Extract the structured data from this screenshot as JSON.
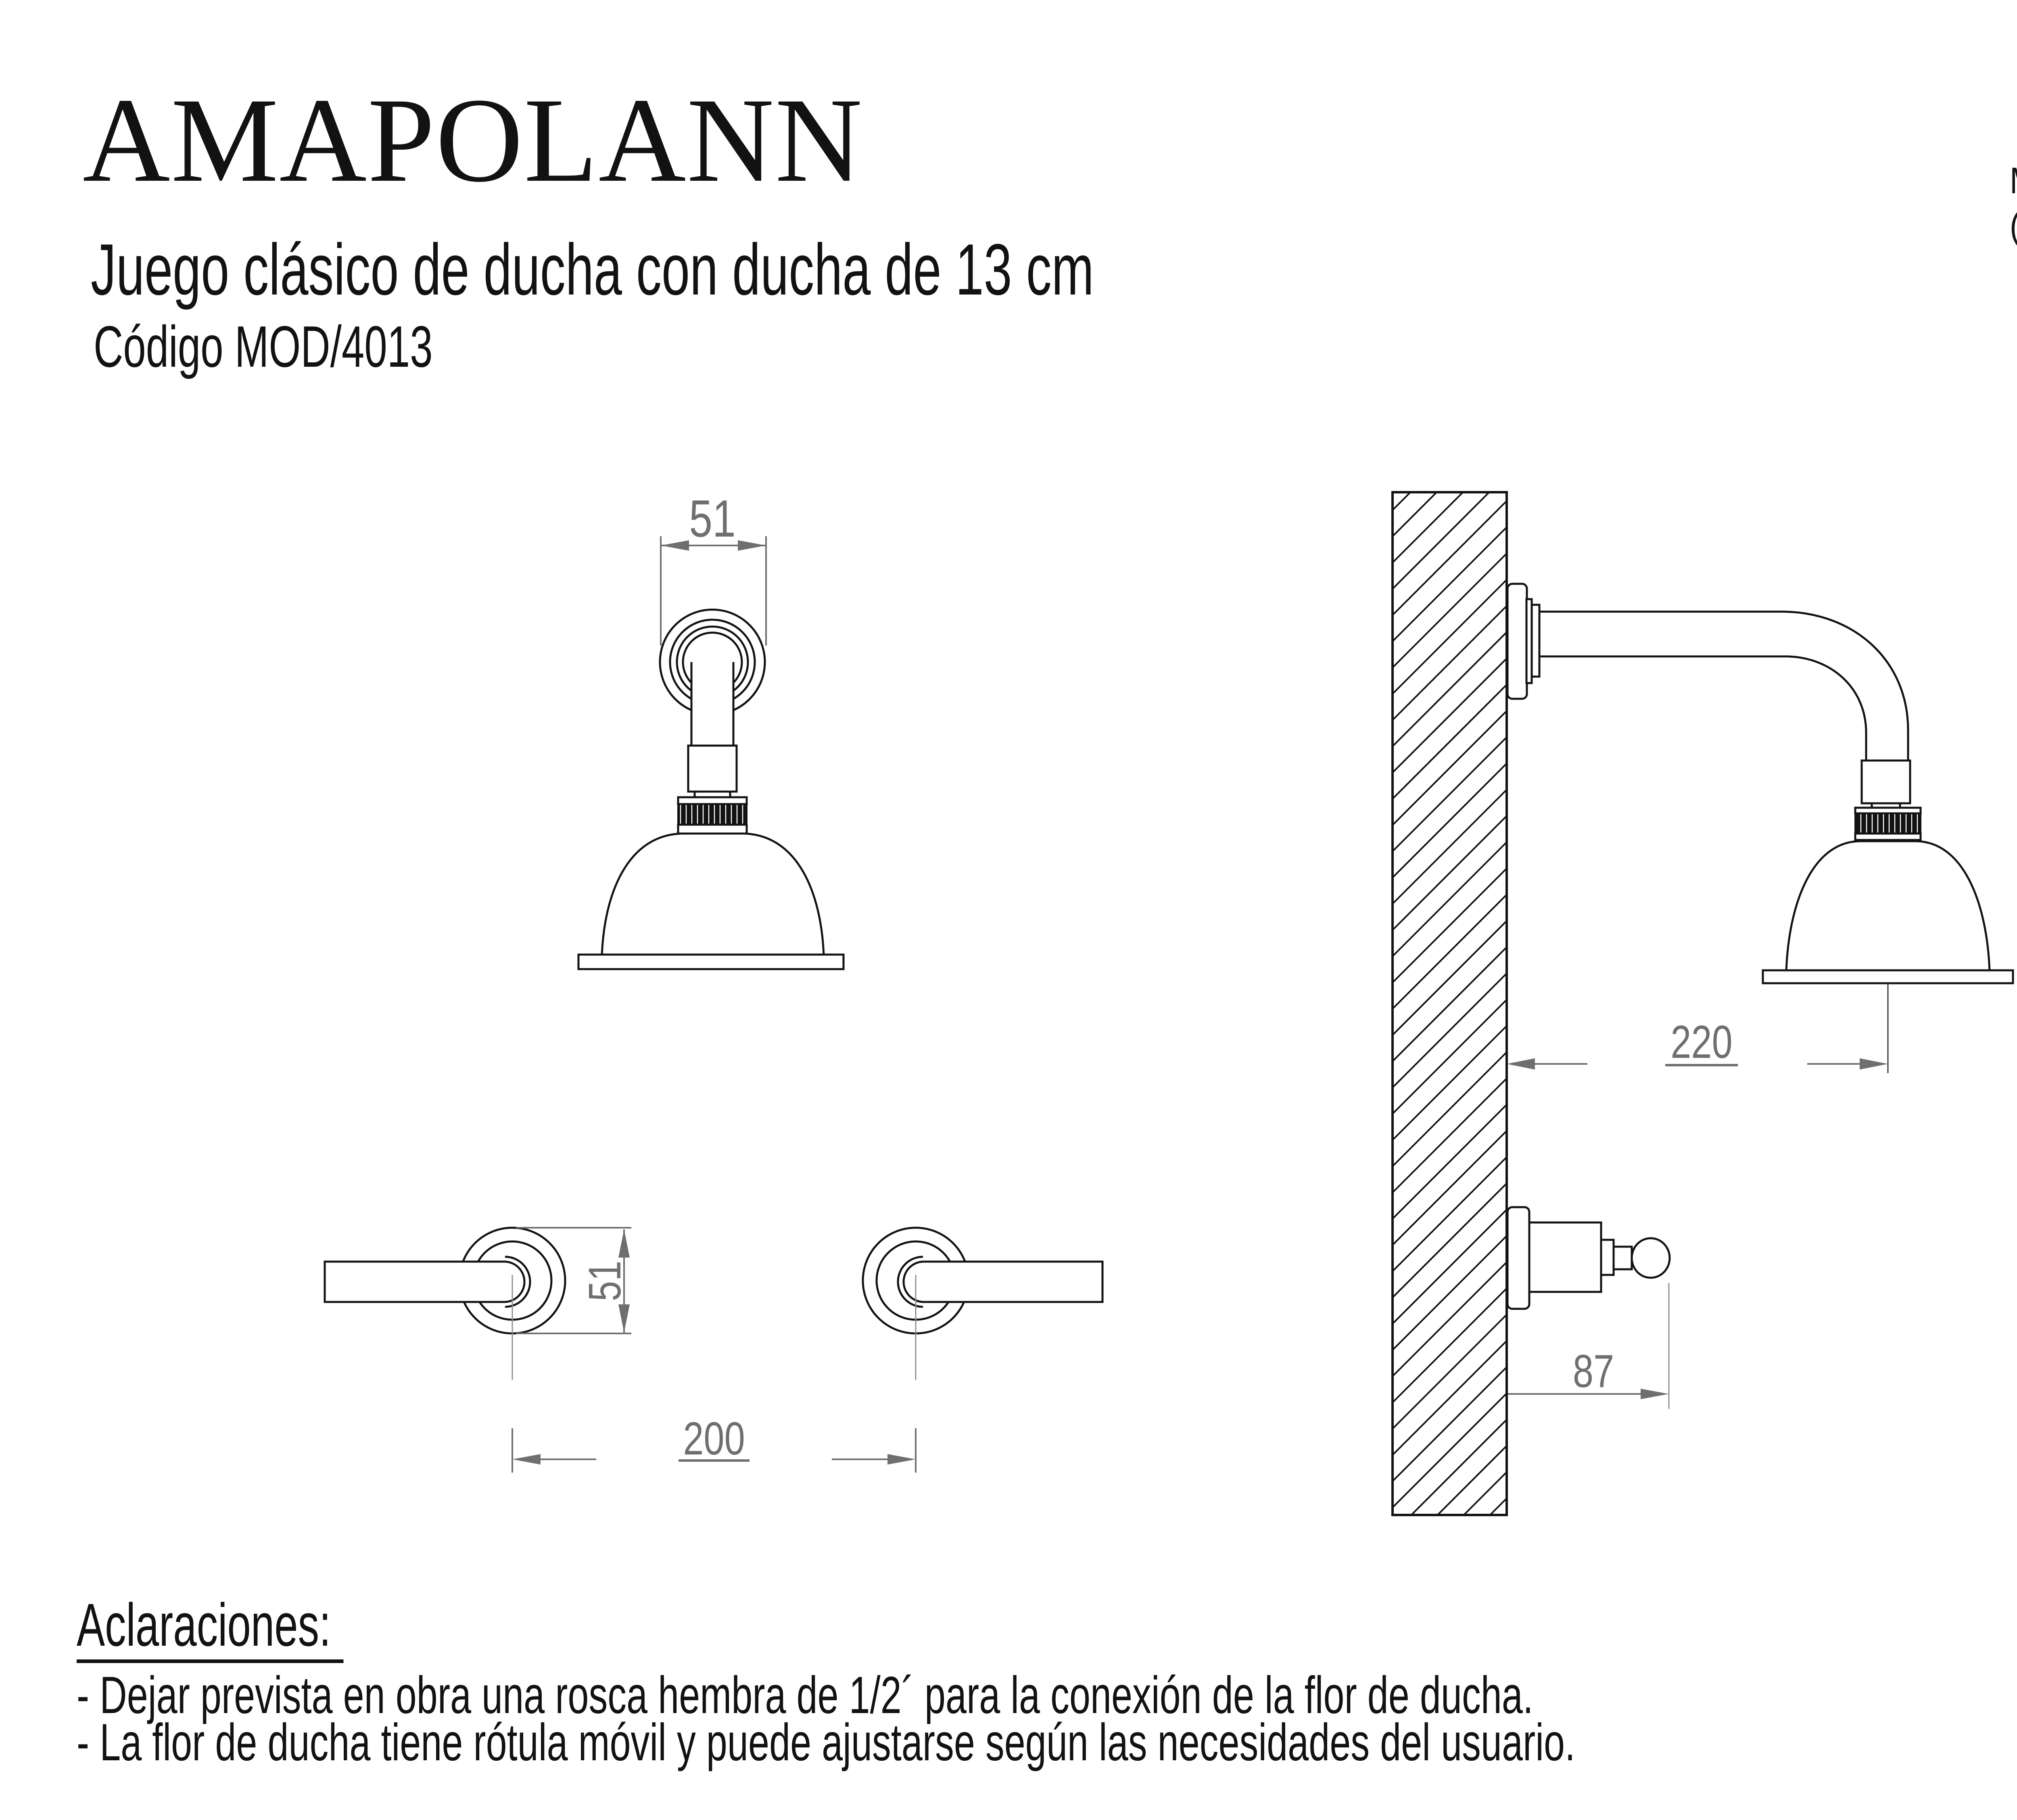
{
  "header": {
    "brand": "AMAPOLANN",
    "subtitle": "Juego clásico de ducha con ducha de 13 cm",
    "code": "Código MOD/4013",
    "units_note_line1": "Medidas en mm.",
    "units_note_line2": "(milimetros)"
  },
  "diagram": {
    "dimensions": {
      "arm_flange_diameter": "51",
      "handle_rosette_diameter": "51",
      "handle_center_distance": "200",
      "arm_projection": "220",
      "valve_projection": "87"
    }
  },
  "notes": {
    "title": "Aclaraciones:",
    "items": [
      "- Dejar prevista en obra una rosca hembra de 1/2´ para la conexión de la flor de ducha.",
      "- La flor de ducha tiene rótula móvil y puede ajustarse según las necesidades del usuario."
    ]
  },
  "colors": {
    "ink": "#121212",
    "dimension": "#6f6f6f",
    "centerline": "#8f8f8f",
    "background": "#ffffff"
  }
}
